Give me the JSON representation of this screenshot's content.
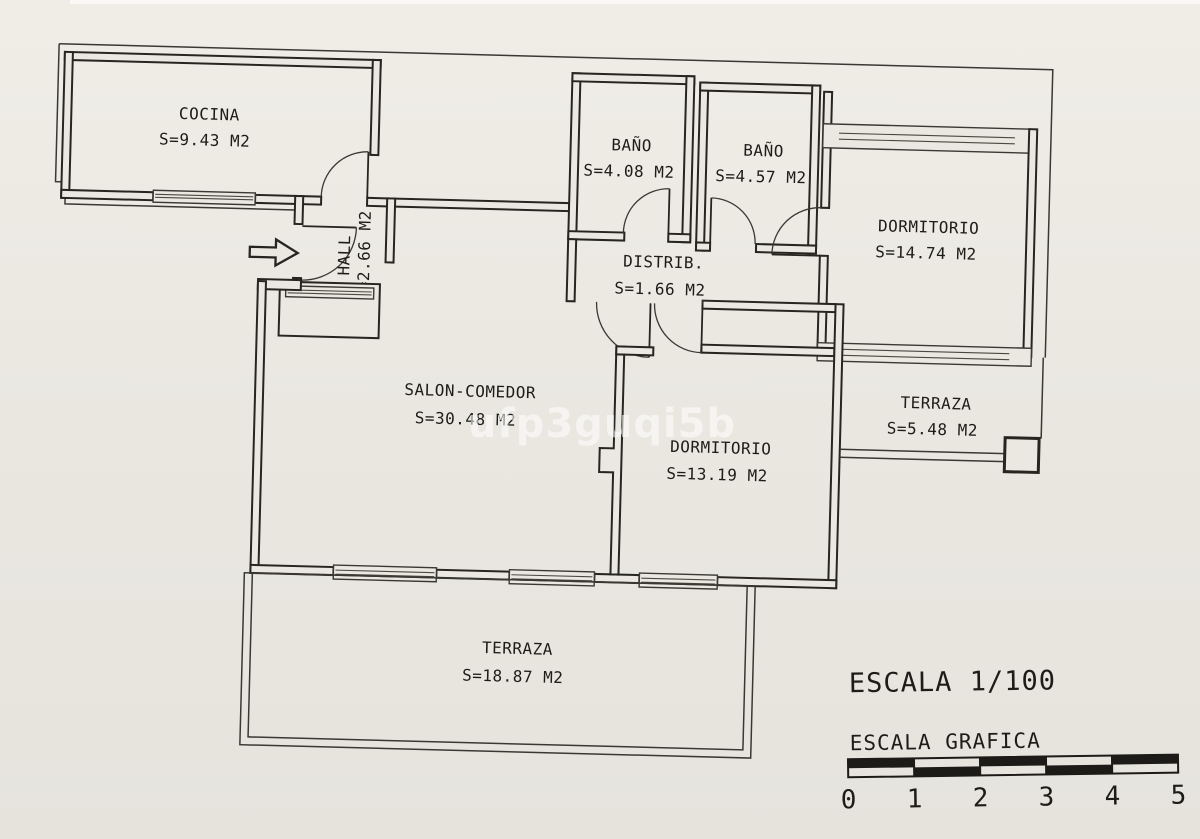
{
  "document": {
    "kind": "apartment floor plan drawing",
    "watermark": "ufp3guqi5b"
  },
  "colors": {
    "paper": "#eae7e1",
    "ink": "#26251f",
    "watermark": "#ffffff"
  },
  "rooms": [
    {
      "name": "COCINA",
      "area": "S=9.43 M2"
    },
    {
      "name": "BAÑO",
      "area": "S=4.08 M2"
    },
    {
      "name": "BAÑO",
      "area": "S=4.57 M2"
    },
    {
      "name": "DORMITORIO",
      "area": "S=14.74 M2"
    },
    {
      "name": "HALL",
      "area": "S=2.66 M2"
    },
    {
      "name": "DISTRIB.",
      "area": "S=1.66 M2"
    },
    {
      "name": "SALON-COMEDOR",
      "area": "S=30.48 M2"
    },
    {
      "name": "DORMITORIO",
      "area": "S=13.19 M2"
    },
    {
      "name": "TERRAZA",
      "area": "S=5.48 M2"
    },
    {
      "name": "TERRAZA",
      "area": "S=18.87 M2"
    }
  ],
  "scale": {
    "title": "ESCALA 1/100",
    "graphic_label": "ESCALA GRAFICA",
    "ticks": [
      "0",
      "1",
      "2",
      "3",
      "4",
      "5"
    ]
  }
}
